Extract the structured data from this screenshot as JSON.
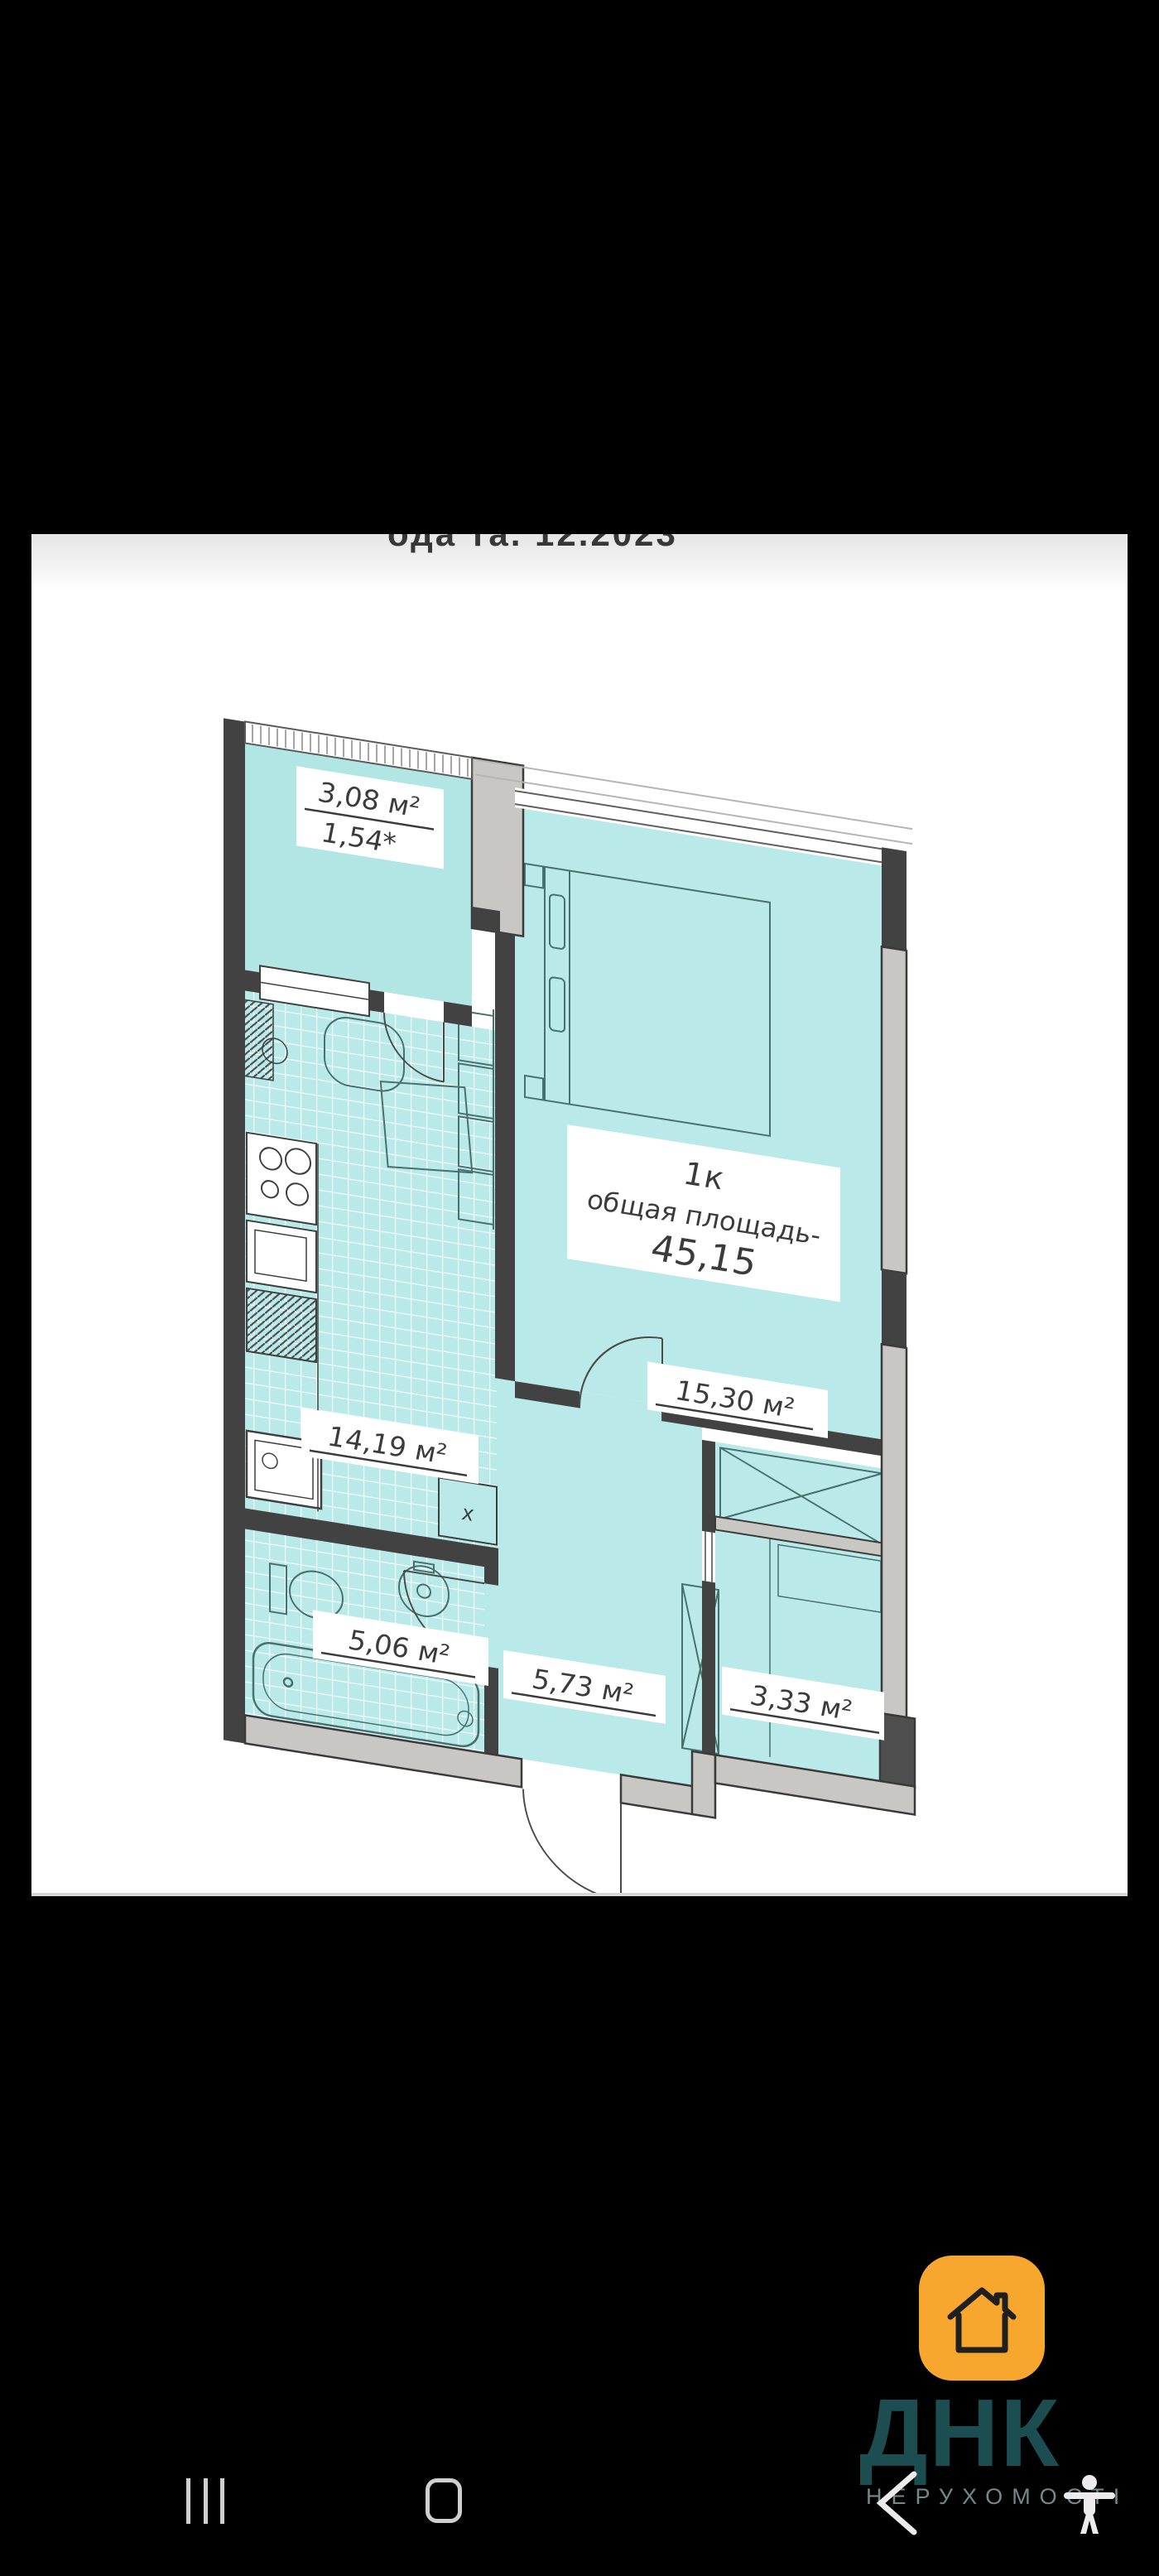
{
  "photo": {
    "top_note": "ода та. 12.2023"
  },
  "plan": {
    "summary": {
      "rooms_type": "1к",
      "area_label": "общая площадь-",
      "area_value": "45,15"
    },
    "rooms": [
      {
        "id": "balcony",
        "area": "3,08 м²",
        "note": "1,54*"
      },
      {
        "id": "bedroom",
        "area": "15,30 м²"
      },
      {
        "id": "kitchen_living",
        "area": "14,19 м²"
      },
      {
        "id": "bathroom",
        "area": "5,06 м²"
      },
      {
        "id": "hallway",
        "area": "5,73 м²"
      },
      {
        "id": "closet",
        "area": "3,33 м²"
      }
    ],
    "marks": {
      "kitchen_cabinet": "х"
    }
  },
  "watermark": {
    "brand": "ДНК",
    "subtitle": "НЕРУХОМОСТІ"
  },
  "colors": {
    "room_teal": "#b9eae9",
    "wall_dark": "#424242",
    "wall_gray": "#c8c7c3",
    "accent_orange": "#f7a62e",
    "brand_teal": "#1c4d50",
    "label_text": "#3b3b3b"
  }
}
